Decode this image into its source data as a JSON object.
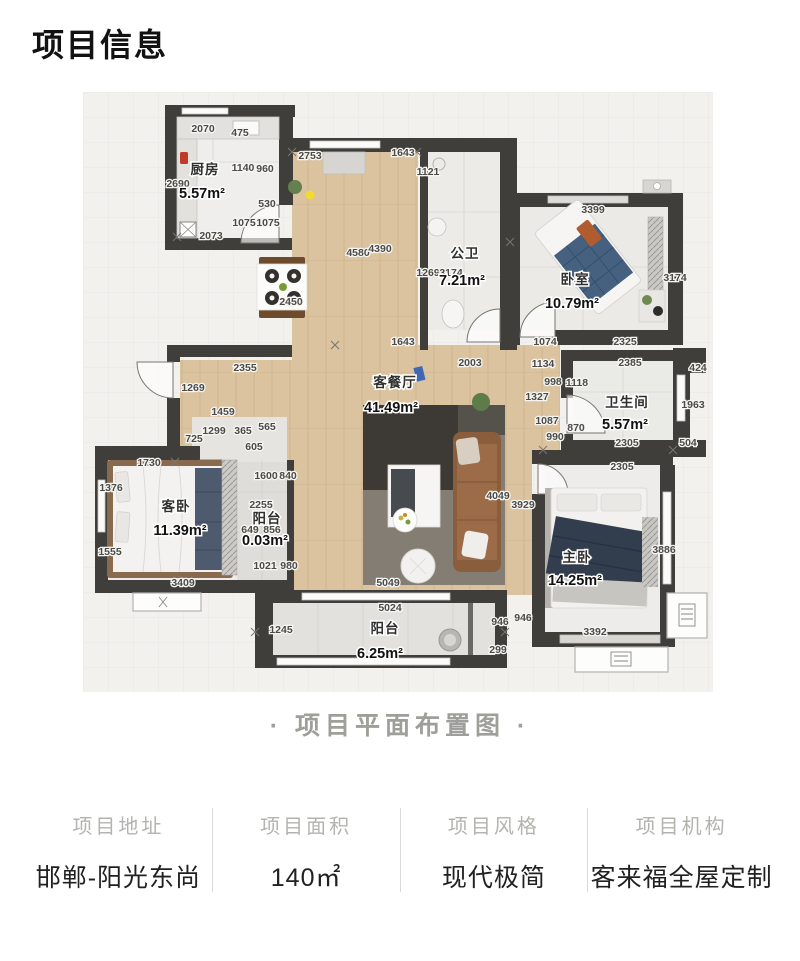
{
  "page": {
    "title": "项目信息",
    "caption": "· 项目平面布置图 ·"
  },
  "info_columns": [
    {
      "label": "项目地址",
      "value": "邯郸-阳光东尚"
    },
    {
      "label": "项目面积",
      "value": "140㎡"
    },
    {
      "label": "项目风格",
      "value": "现代极简"
    },
    {
      "label": "项目机构",
      "value": "客来福全屋定制"
    }
  ],
  "floorplan": {
    "rooms": [
      {
        "name": "厨房",
        "area": "5.57m²",
        "x": 122,
        "y": 82,
        "ax": 119,
        "ay": 106
      },
      {
        "name": "公卫",
        "area": "7.21m²",
        "x": 382,
        "y": 166,
        "ax": 379,
        "ay": 193
      },
      {
        "name": "卧室",
        "area": "10.79m²",
        "x": 492,
        "y": 192,
        "ax": 489,
        "ay": 216
      },
      {
        "name": "客餐厅",
        "area": "41.49m²",
        "x": 312,
        "y": 295,
        "ax": 308,
        "ay": 320
      },
      {
        "name": "卫生间",
        "area": "5.57m²",
        "x": 544,
        "y": 315,
        "ax": 542,
        "ay": 337
      },
      {
        "name": "客卧",
        "area": "11.39m²",
        "x": 93,
        "y": 419,
        "ax": 97,
        "ay": 443
      },
      {
        "name": "阳台",
        "area": "0.03m²",
        "x": 184,
        "y": 431,
        "ax": 182,
        "ay": 453
      },
      {
        "name": "主卧",
        "area": "14.25m²",
        "x": 494,
        "y": 470,
        "ax": 492,
        "ay": 493
      },
      {
        "name": "阳台",
        "area": "6.25m²",
        "x": 302,
        "y": 541,
        "ax": 297,
        "ay": 566
      }
    ],
    "dimensions": [
      {
        "t": "2070",
        "x": 120,
        "y": 40
      },
      {
        "t": "475",
        "x": 157,
        "y": 44
      },
      {
        "t": "2690",
        "x": 95,
        "y": 95
      },
      {
        "t": "1140",
        "x": 160,
        "y": 79
      },
      {
        "t": "960",
        "x": 182,
        "y": 80
      },
      {
        "t": "530",
        "x": 184,
        "y": 115
      },
      {
        "t": "1075",
        "x": 161,
        "y": 134
      },
      {
        "t": "1075",
        "x": 185,
        "y": 134
      },
      {
        "t": "2073",
        "x": 128,
        "y": 147
      },
      {
        "t": "2753",
        "x": 227,
        "y": 67
      },
      {
        "t": "4580",
        "x": 275,
        "y": 164
      },
      {
        "t": "4390",
        "x": 297,
        "y": 160
      },
      {
        "t": "2450",
        "x": 208,
        "y": 213
      },
      {
        "t": "1643",
        "x": 320,
        "y": 64
      },
      {
        "t": "1121",
        "x": 345,
        "y": 83
      },
      {
        "t": "1269",
        "x": 345,
        "y": 184
      },
      {
        "t": "3174",
        "x": 368,
        "y": 184
      },
      {
        "t": "3399",
        "x": 510,
        "y": 121
      },
      {
        "t": "3174",
        "x": 592,
        "y": 189
      },
      {
        "t": "1643",
        "x": 320,
        "y": 253
      },
      {
        "t": "1074",
        "x": 462,
        "y": 253
      },
      {
        "t": "2325",
        "x": 542,
        "y": 253
      },
      {
        "t": "2003",
        "x": 387,
        "y": 274
      },
      {
        "t": "1134",
        "x": 460,
        "y": 275
      },
      {
        "t": "998",
        "x": 470,
        "y": 293
      },
      {
        "t": "1118",
        "x": 494,
        "y": 294
      },
      {
        "t": "1327",
        "x": 454,
        "y": 308
      },
      {
        "t": "1087",
        "x": 464,
        "y": 332
      },
      {
        "t": "870",
        "x": 493,
        "y": 339
      },
      {
        "t": "990",
        "x": 472,
        "y": 348
      },
      {
        "t": "2385",
        "x": 547,
        "y": 274
      },
      {
        "t": "424",
        "x": 615,
        "y": 279
      },
      {
        "t": "1963",
        "x": 610,
        "y": 316
      },
      {
        "t": "2305",
        "x": 544,
        "y": 354
      },
      {
        "t": "504",
        "x": 605,
        "y": 354
      },
      {
        "t": "2305",
        "x": 539,
        "y": 378
      },
      {
        "t": "2355",
        "x": 162,
        "y": 279
      },
      {
        "t": "1269",
        "x": 110,
        "y": 299
      },
      {
        "t": "1459",
        "x": 140,
        "y": 323
      },
      {
        "t": "1299",
        "x": 131,
        "y": 342
      },
      {
        "t": "365",
        "x": 160,
        "y": 342
      },
      {
        "t": "565",
        "x": 184,
        "y": 338
      },
      {
        "t": "725",
        "x": 111,
        "y": 350
      },
      {
        "t": "605",
        "x": 171,
        "y": 358
      },
      {
        "t": "1730",
        "x": 66,
        "y": 374
      },
      {
        "t": "1376",
        "x": 28,
        "y": 399
      },
      {
        "t": "1600",
        "x": 183,
        "y": 387
      },
      {
        "t": "840",
        "x": 205,
        "y": 387
      },
      {
        "t": "2255",
        "x": 178,
        "y": 416
      },
      {
        "t": "649",
        "x": 167,
        "y": 441
      },
      {
        "t": "856",
        "x": 189,
        "y": 441
      },
      {
        "t": "1555",
        "x": 27,
        "y": 463
      },
      {
        "t": "3409",
        "x": 100,
        "y": 494
      },
      {
        "t": "1021",
        "x": 182,
        "y": 477
      },
      {
        "t": "980",
        "x": 206,
        "y": 477
      },
      {
        "t": "4049",
        "x": 415,
        "y": 407
      },
      {
        "t": "3929",
        "x": 440,
        "y": 416
      },
      {
        "t": "5049",
        "x": 305,
        "y": 494
      },
      {
        "t": "5024",
        "x": 307,
        "y": 519
      },
      {
        "t": "1245",
        "x": 198,
        "y": 541
      },
      {
        "t": "946",
        "x": 417,
        "y": 533
      },
      {
        "t": "946",
        "x": 440,
        "y": 529
      },
      {
        "t": "299",
        "x": 415,
        "y": 561
      },
      {
        "t": "3886",
        "x": 581,
        "y": 461
      },
      {
        "t": "3392",
        "x": 512,
        "y": 543
      }
    ]
  }
}
